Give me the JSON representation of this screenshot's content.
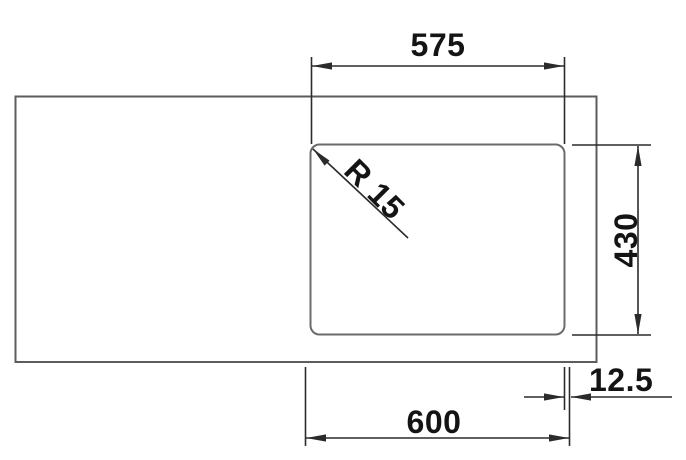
{
  "drawing": {
    "background_color": "#ffffff",
    "outline_color": "#5c5c5c",
    "bowl_outline_color": "#6b6b6b",
    "dimension_line_color": "#2b2b2b",
    "label_color": "#141414",
    "labels": {
      "width_top": "575",
      "bowl_height": "430",
      "width_bottom": "600",
      "edge_offset": "12.5",
      "corner_radius": "R 15"
    }
  }
}
